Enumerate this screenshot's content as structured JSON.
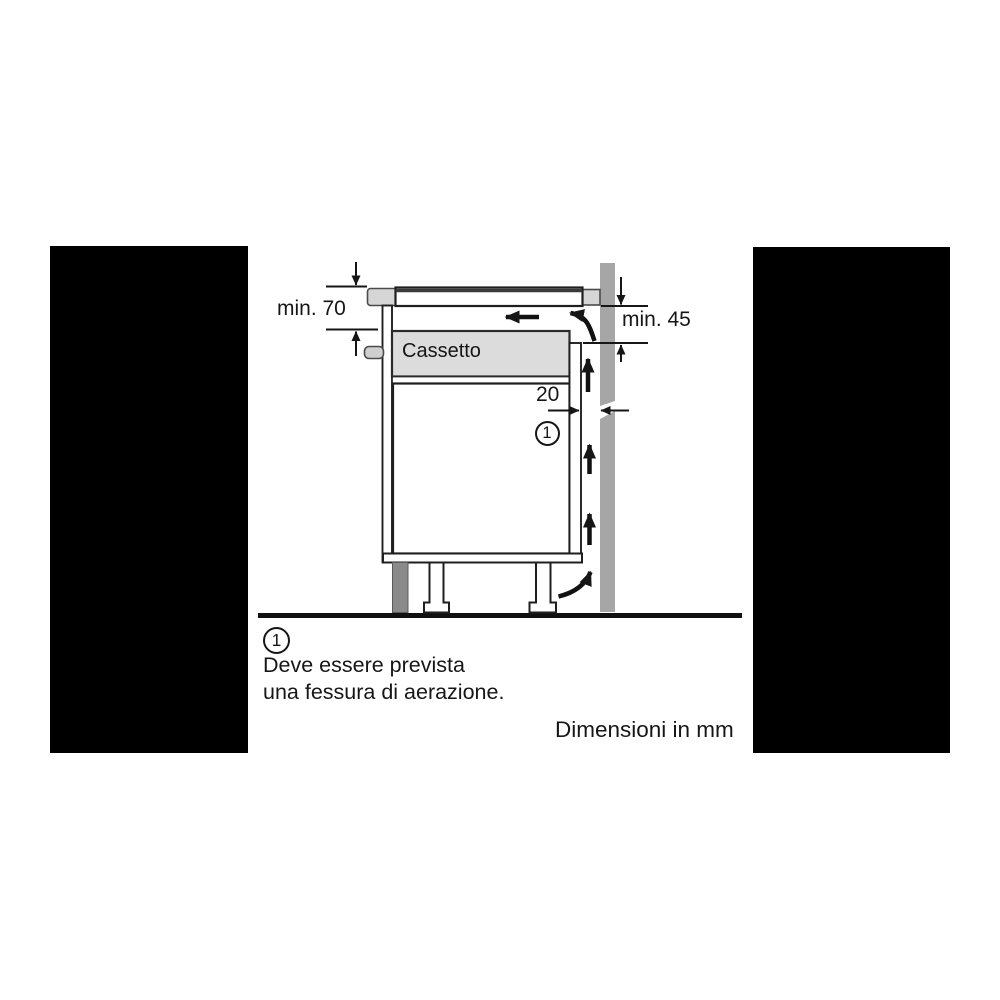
{
  "colors": {
    "mask": "#000000",
    "wall": "#a6a6a6",
    "worktop": "#d6d6d6",
    "drawer_fill": "#dcdcdc",
    "handle": "#cfcfcf",
    "plinth": "#8a8a8a",
    "line": "#161616"
  },
  "diagram": {
    "drawer_label": "Cassetto",
    "dimensions": {
      "worktop_to_drawer_left": "min. 70",
      "hob_bottom_clearance_right": "min. 45",
      "rear_ventilation_gap": "20"
    },
    "callout": {
      "marker": "1"
    }
  },
  "footnote": {
    "marker": "1",
    "line1": "Deve essere prevista",
    "line2": "una fessura di aerazione."
  },
  "units_note": "Dimensioni in mm"
}
